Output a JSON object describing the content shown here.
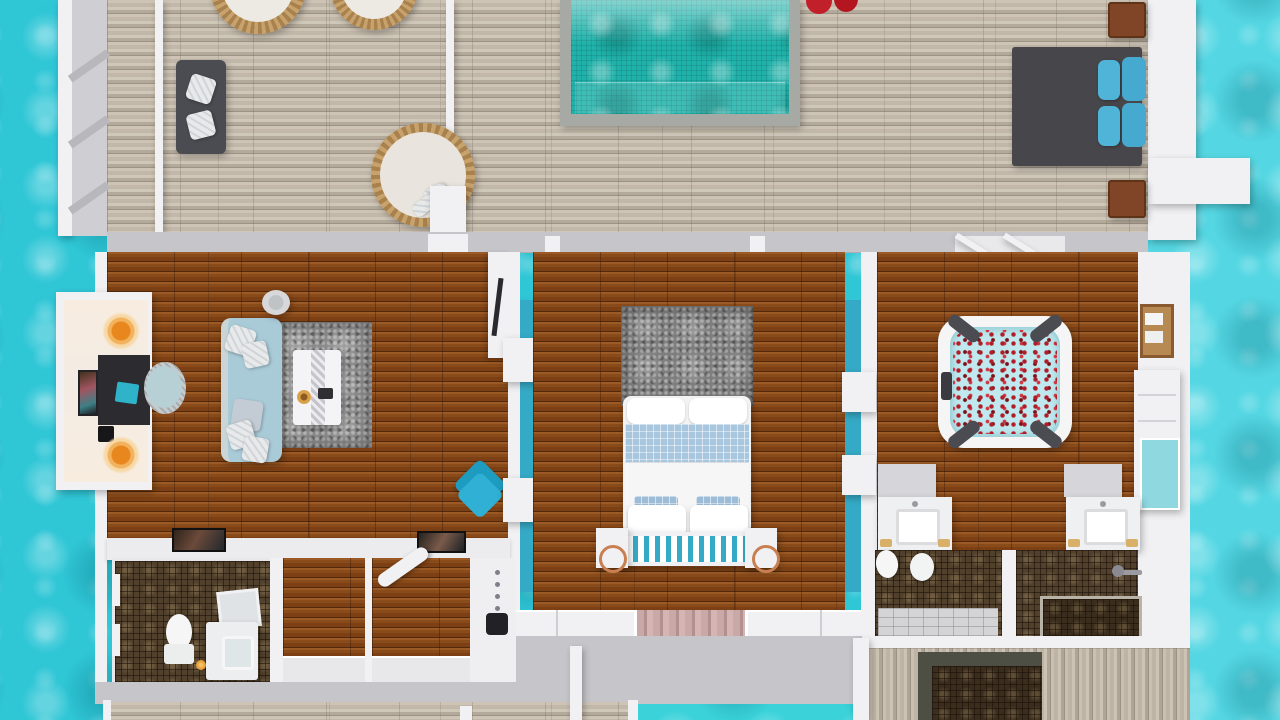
{
  "scene": {
    "type": "3d-floorplan-top-down-render",
    "setting": "overwater-villa",
    "rooms": [
      "sun-deck",
      "plunge-pool",
      "living-room",
      "writing-nook",
      "bedroom",
      "spa-room",
      "bathroom",
      "dressing-area",
      "shower-room",
      "outdoor-shower-deck",
      "rear-plunge-pool"
    ],
    "furniture": [
      "outdoor-sofa",
      "hanging-wicker-chairs",
      "round-daybed",
      "sun-platform",
      "pool-loungers",
      "side-tables",
      "writing-desk",
      "desk-lamps",
      "wall-art",
      "desk-chair-pouf",
      "living-sofa",
      "coffee-table",
      "drinks-table",
      "accent-chair",
      "wall-tv",
      "shag-rugs",
      "double-bed",
      "foot-bench",
      "nightstands",
      "wardrobes",
      "curtains",
      "hot-tub-with-rose-petals",
      "towel-ladder",
      "shelf-unit",
      "double-vanities",
      "toilets",
      "showers",
      "ironing-board"
    ]
  },
  "colors": {
    "water": "#2fc6d6",
    "water-light": "#55d7e3",
    "bottom-pool": "#3bd2da",
    "pool": "#1fb2aa",
    "deck": "#c7beb0",
    "deck-line": "#9d9385",
    "wood": "#8a4c1e",
    "wall-white": "#f1f1f3",
    "wall-gray": "#c6c6ca",
    "teal-accent": "#35aac6",
    "sofa-blue": "#a9cbd8",
    "rug-gray": "#8b8b8b",
    "dark-furniture": "#4b4b52",
    "lounger-blue": "#4fb4d8",
    "lamp-orange": "#e8871e",
    "petal-red": "#b01d29",
    "curtain-pink": "#c9a8a8",
    "mosaic-brown": "#50402c",
    "copper": "#c87f52",
    "towel-gold": "#d9b06a",
    "wicker-tan": "#c8a26c",
    "quilt-blue": "#a9c6df",
    "jacuzzi-water": "#bfe9ef"
  }
}
